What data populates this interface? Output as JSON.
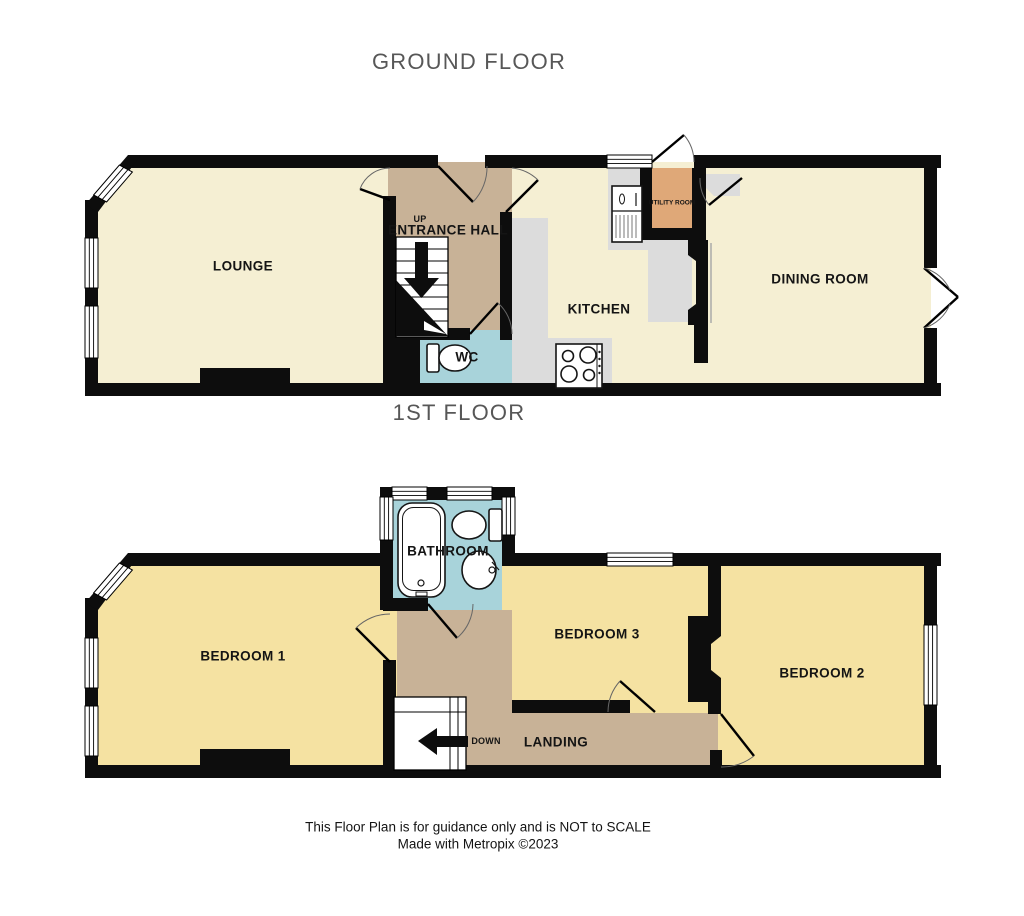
{
  "ground_floor": {
    "title": "GROUND FLOOR",
    "stairs_label": "UP",
    "rooms": {
      "lounge": {
        "label": "LOUNGE"
      },
      "entrance_hall": {
        "label": "ENTRANCE HALL"
      },
      "wc": {
        "label": "WC"
      },
      "kitchen": {
        "label": "KITCHEN"
      },
      "utility": {
        "label": "UTILITY ROOM"
      },
      "dining": {
        "label": "DINING ROOM"
      }
    }
  },
  "first_floor": {
    "title": "1ST FLOOR",
    "stairs_label": "DOWN",
    "rooms": {
      "bedroom1": {
        "label": "BEDROOM 1"
      },
      "bathroom": {
        "label": "BATHROOM"
      },
      "bedroom3": {
        "label": "BEDROOM 3"
      },
      "bedroom2": {
        "label": "BEDROOM 2"
      },
      "landing": {
        "label": "LANDING"
      }
    }
  },
  "footer": {
    "disclaimer": "This Floor Plan is for guidance only and is NOT to SCALE",
    "credit": "Made with Metropix ©2023"
  },
  "colors": {
    "wall": "#0d0d0d",
    "room_cream": "#f5efd3",
    "room_yellow": "#f5e2a2",
    "hall_tan": "#c8b297",
    "wet_blue": "#a8d3da",
    "utility_orange": "#dfa878",
    "counter_gray": "#dcdcdc",
    "title_gray": "#575757",
    "text_black": "#141414"
  }
}
